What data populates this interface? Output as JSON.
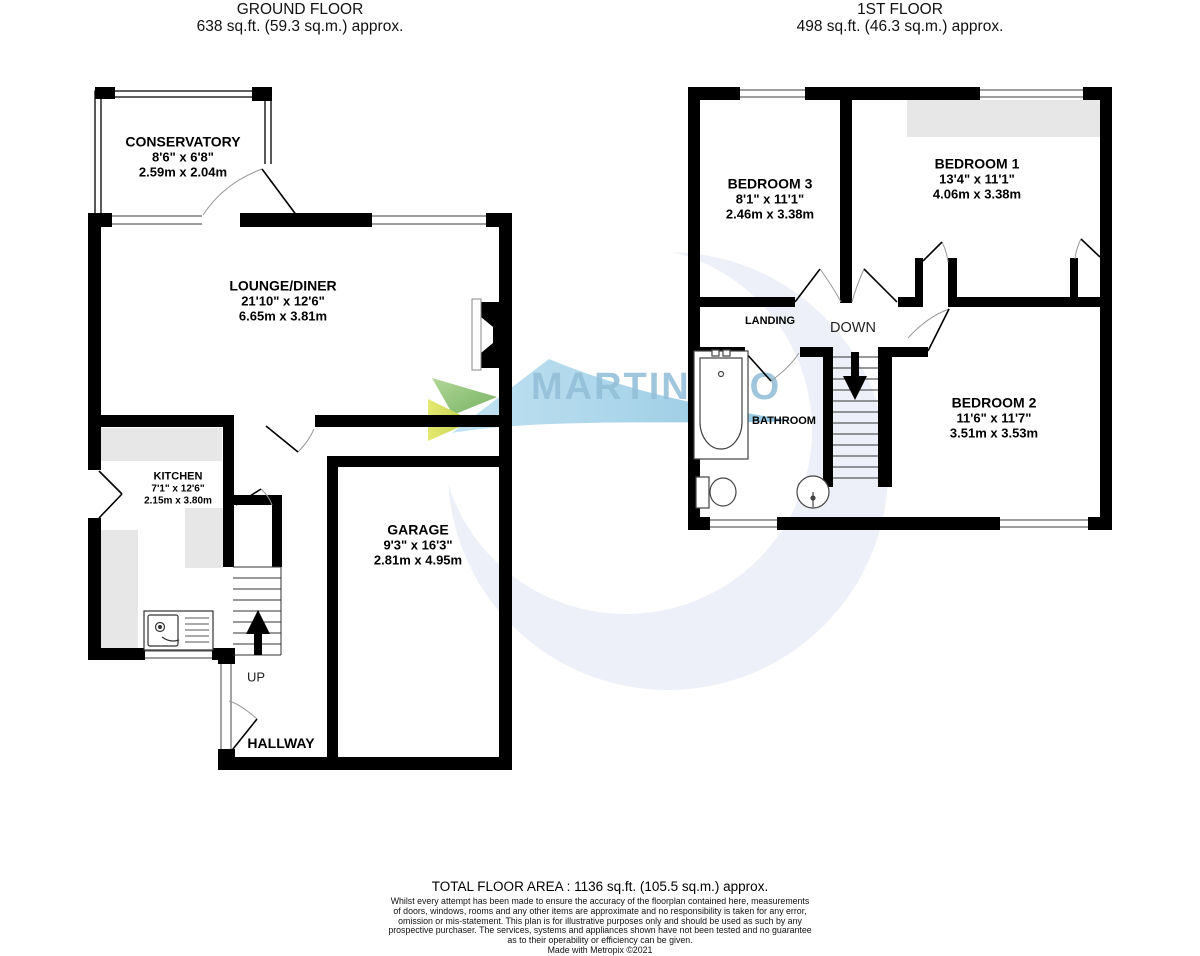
{
  "header": {
    "ground_floor": {
      "title": "GROUND FLOOR",
      "area": "638 sq.ft. (59.3 sq.m.) approx."
    },
    "first_floor": {
      "title": "1ST FLOOR",
      "area": "498 sq.ft. (46.3 sq.m.) approx."
    }
  },
  "rooms": {
    "conservatory": {
      "name": "CONSERVATORY",
      "imperial": "8'6\"  x 6'8\"",
      "metric": "2.59m  x 2.04m"
    },
    "lounge": {
      "name": "LOUNGE/DINER",
      "imperial": "21'10\"  x 12'6\"",
      "metric": "6.65m  x 3.81m"
    },
    "kitchen": {
      "name": "KITCHEN",
      "imperial": "7'1\"  x 12'6\"",
      "metric": "2.15m  x 3.80m"
    },
    "garage": {
      "name": "GARAGE",
      "imperial": "9'3\"  x 16'3\"",
      "metric": "2.81m  x 4.95m"
    },
    "bedroom1": {
      "name": "BEDROOM 1",
      "imperial": "13'4\"  x 11'1\"",
      "metric": "4.06m  x 3.38m"
    },
    "bedroom2": {
      "name": "BEDROOM 2",
      "imperial": "11'6\"  x 11'7\"",
      "metric": "3.51m  x 3.53m"
    },
    "bedroom3": {
      "name": "BEDROOM 3",
      "imperial": "8'1\"  x 11'1\"",
      "metric": "2.46m  x 3.38m"
    }
  },
  "labels": {
    "hallway": "HALLWAY",
    "landing": "LANDING",
    "bathroom": "BATHROOM",
    "up": "UP",
    "down": "DOWN"
  },
  "watermark": {
    "brand_left": "MARTIN",
    "brand_amp": "&",
    "brand_right": "CO"
  },
  "colors": {
    "wall": "#000000",
    "counter_gray": "#e7e7e7",
    "watermark_circle": "#edf0f8",
    "brand_blue": "#8fbdd6",
    "brand_amp_blue": "#b9d8e6",
    "leaf_green": "#93c57b",
    "leaf_lime": "#ccd94e",
    "swoosh_blue": "#a7d2e6"
  },
  "footer": {
    "total_area": "TOTAL FLOOR AREA : 1136 sq.ft. (105.5 sq.m.) approx.",
    "disclaimer": [
      "Whilst every attempt has been made to ensure the accuracy of the floorplan contained here, measurements",
      "of doors, windows, rooms and any other items are approximate and no responsibility is taken for any error,",
      "omission or mis-statement. This plan is for illustrative purposes only and should be used as such by any",
      "prospective purchaser. The services, systems and appliances shown have not been tested and no guarantee",
      "as to their operability or efficiency can be given."
    ],
    "credit": "Made with Metropix ©2021"
  }
}
